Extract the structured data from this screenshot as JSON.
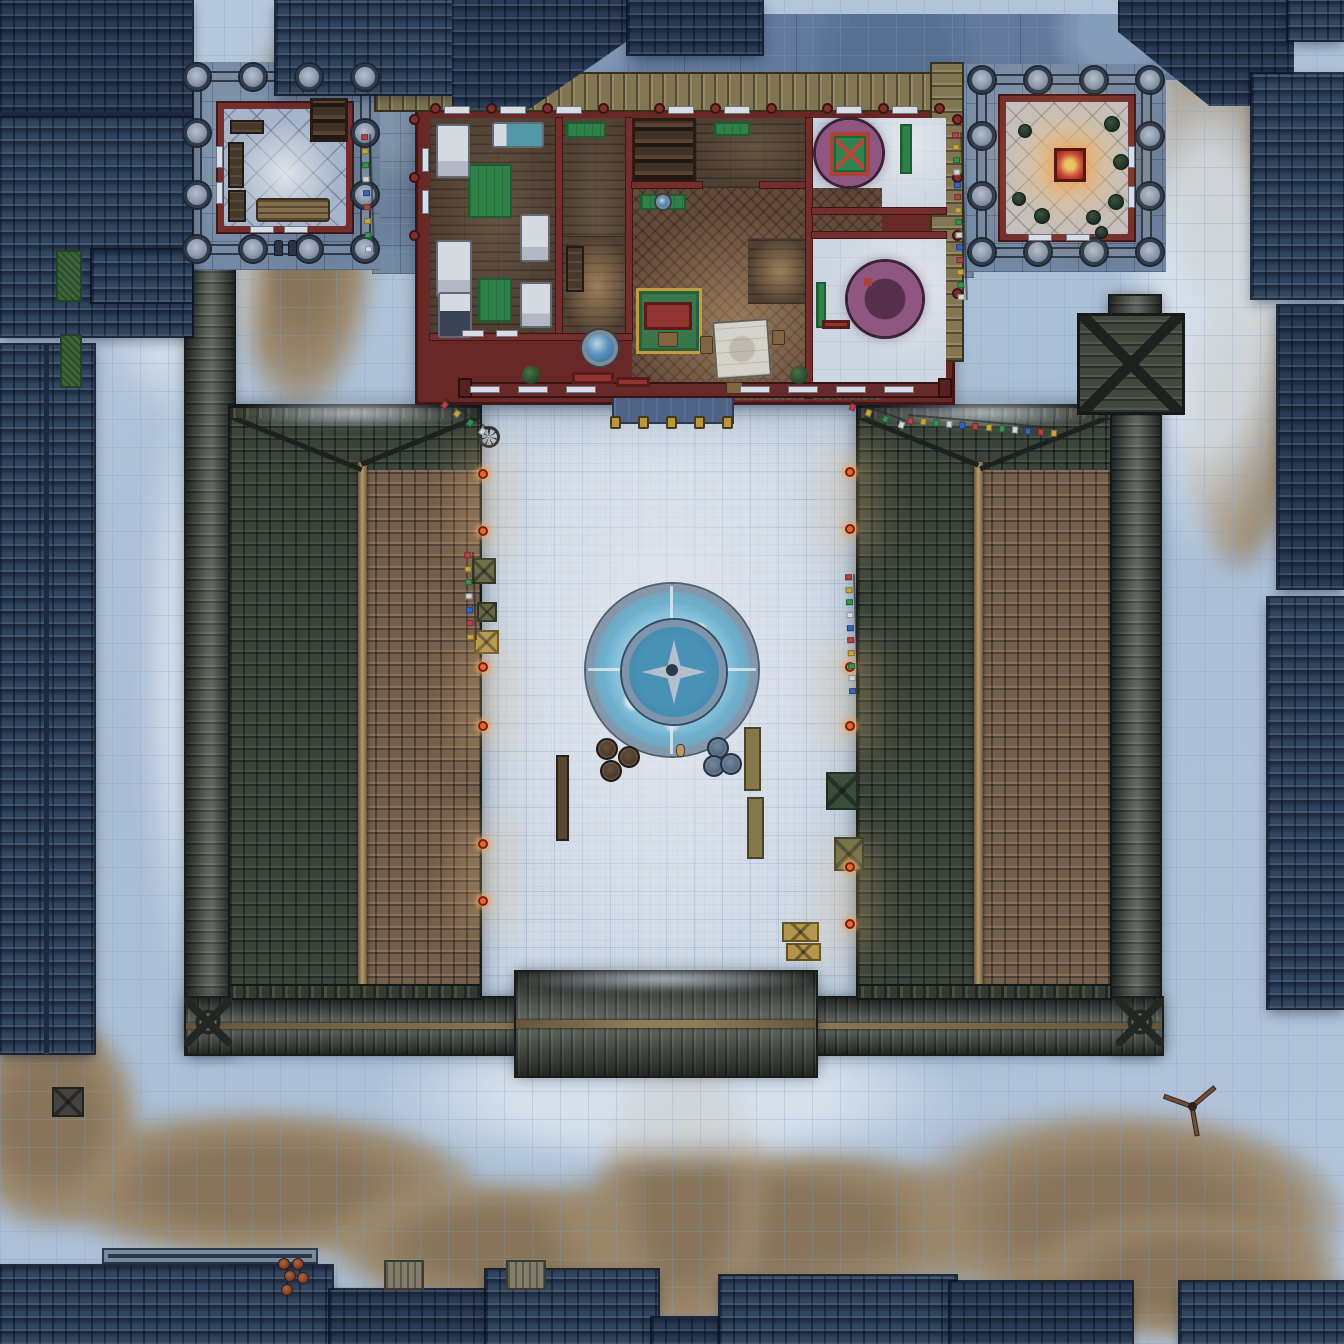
{
  "map": {
    "kind": "top-down fantasy battle map",
    "scene": "snow-covered walled temple compound at night with central frozen fountain courtyard, flanking tiled-roof wings, a northern living-quarters building with two corner towers, a southern gate, and surrounding city rooftops",
    "grid": {
      "columns": 48,
      "rows": 48,
      "cell_px": 28,
      "line_color": "rgba(140,170,205,0.28)"
    },
    "palette": {
      "snow": "#c3d5e7",
      "snow_bright": "#e9f2f9",
      "dirt": "#a8906a",
      "stone_path": "#7d92aa",
      "city_roof": "#33475e",
      "city_roof_dark": "#2a3c52",
      "compound_wall": "#454a37",
      "wing_roof_dark": "#3e4634",
      "wing_roof_lit": "#7d6349",
      "ridge_beam": "#a58a5c",
      "building_red": "#7c2d26",
      "wood_floor": "#55412d",
      "hall_floor": "#6b4c34",
      "tatami_green": "#2f8a43",
      "bath_purple": "#8f4f79",
      "marble_floor": "#dfe7ee",
      "courtyard_ice": "#e3ecf4",
      "fountain_water": "#a9dcee",
      "lamp_orange": "#ff6a2a",
      "lamp_glow": "rgba(255,205,125,0.30)",
      "gold": "#c9a23e",
      "shrine_glow": "#ffd166",
      "flag_colors": [
        "#c44444",
        "#d9b33a",
        "#3a9a4e",
        "#e8e8e8",
        "#3a6ac4"
      ]
    },
    "features": [
      "frozen-fountain",
      "courtyard",
      "left-wing-roof",
      "right-wing-roof",
      "north-building",
      "left-tower",
      "right-tower",
      "glowing-shrine",
      "south-gate",
      "east-gatehouse",
      "prayer-flags",
      "city-rooftops"
    ]
  },
  "objects": {
    "tower_pillars": [
      {
        "x": 184,
        "y": 64
      },
      {
        "x": 240,
        "y": 64
      },
      {
        "x": 296,
        "y": 64
      },
      {
        "x": 352,
        "y": 64
      },
      {
        "x": 184,
        "y": 120
      },
      {
        "x": 352,
        "y": 120
      },
      {
        "x": 184,
        "y": 182
      },
      {
        "x": 352,
        "y": 182
      },
      {
        "x": 184,
        "y": 236
      },
      {
        "x": 240,
        "y": 236
      },
      {
        "x": 296,
        "y": 236
      },
      {
        "x": 352,
        "y": 236
      },
      {
        "x": 969,
        "y": 67
      },
      {
        "x": 1025,
        "y": 67
      },
      {
        "x": 1081,
        "y": 67
      },
      {
        "x": 1137,
        "y": 67
      },
      {
        "x": 969,
        "y": 123
      },
      {
        "x": 1137,
        "y": 123
      },
      {
        "x": 969,
        "y": 183
      },
      {
        "x": 1137,
        "y": 183
      },
      {
        "x": 969,
        "y": 239
      },
      {
        "x": 1025,
        "y": 239
      },
      {
        "x": 1081,
        "y": 239
      },
      {
        "x": 1137,
        "y": 239
      }
    ],
    "lamps": [
      {
        "x": 478,
        "y": 469
      },
      {
        "x": 478,
        "y": 526
      },
      {
        "x": 478,
        "y": 662
      },
      {
        "x": 478,
        "y": 721
      },
      {
        "x": 478,
        "y": 839
      },
      {
        "x": 478,
        "y": 896
      },
      {
        "x": 845,
        "y": 467
      },
      {
        "x": 845,
        "y": 524
      },
      {
        "x": 845,
        "y": 662
      },
      {
        "x": 845,
        "y": 721
      },
      {
        "x": 845,
        "y": 862
      },
      {
        "x": 845,
        "y": 919
      }
    ],
    "gold_posts": [
      {
        "x": 610,
        "y": 416
      },
      {
        "x": 638,
        "y": 416
      },
      {
        "x": 666,
        "y": 416
      },
      {
        "x": 694,
        "y": 416
      },
      {
        "x": 722,
        "y": 416
      }
    ],
    "wall_caps": [
      {
        "x": 430,
        "y": 103
      },
      {
        "x": 486,
        "y": 103
      },
      {
        "x": 542,
        "y": 103
      },
      {
        "x": 598,
        "y": 103
      },
      {
        "x": 654,
        "y": 103
      },
      {
        "x": 710,
        "y": 103
      },
      {
        "x": 766,
        "y": 103
      },
      {
        "x": 822,
        "y": 103
      },
      {
        "x": 878,
        "y": 103
      },
      {
        "x": 934,
        "y": 103
      },
      {
        "x": 409,
        "y": 114
      },
      {
        "x": 409,
        "y": 172
      },
      {
        "x": 409,
        "y": 230
      },
      {
        "x": 952,
        "y": 114
      },
      {
        "x": 952,
        "y": 172
      },
      {
        "x": 952,
        "y": 230
      },
      {
        "x": 952,
        "y": 288
      }
    ],
    "south_posts": [
      {
        "x": 458,
        "y": 378
      },
      {
        "x": 938,
        "y": 378
      }
    ],
    "windows": [
      {
        "x": 444,
        "y": 106,
        "w": 26,
        "h": 8
      },
      {
        "x": 500,
        "y": 106,
        "w": 26,
        "h": 8
      },
      {
        "x": 556,
        "y": 106,
        "w": 26,
        "h": 8
      },
      {
        "x": 668,
        "y": 106,
        "w": 26,
        "h": 8
      },
      {
        "x": 724,
        "y": 106,
        "w": 26,
        "h": 8
      },
      {
        "x": 836,
        "y": 106,
        "w": 26,
        "h": 8
      },
      {
        "x": 892,
        "y": 106,
        "w": 26,
        "h": 8
      },
      {
        "x": 422,
        "y": 148,
        "w": 7,
        "h": 24
      },
      {
        "x": 422,
        "y": 190,
        "w": 7,
        "h": 24
      },
      {
        "x": 462,
        "y": 330,
        "w": 22,
        "h": 7
      },
      {
        "x": 496,
        "y": 330,
        "w": 22,
        "h": 7
      },
      {
        "x": 216,
        "y": 146,
        "w": 7,
        "h": 22
      },
      {
        "x": 216,
        "y": 182,
        "w": 7,
        "h": 22
      },
      {
        "x": 250,
        "y": 226,
        "w": 24,
        "h": 7
      },
      {
        "x": 284,
        "y": 226,
        "w": 24,
        "h": 7
      },
      {
        "x": 1128,
        "y": 146,
        "w": 7,
        "h": 22
      },
      {
        "x": 1128,
        "y": 186,
        "w": 7,
        "h": 22
      },
      {
        "x": 1028,
        "y": 234,
        "w": 24,
        "h": 7
      },
      {
        "x": 1066,
        "y": 234,
        "w": 24,
        "h": 7
      },
      {
        "x": 470,
        "y": 386,
        "w": 30,
        "h": 7
      },
      {
        "x": 518,
        "y": 386,
        "w": 30,
        "h": 7
      },
      {
        "x": 566,
        "y": 386,
        "w": 30,
        "h": 7
      },
      {
        "x": 740,
        "y": 386,
        "w": 30,
        "h": 7
      },
      {
        "x": 788,
        "y": 386,
        "w": 30,
        "h": 7
      },
      {
        "x": 836,
        "y": 386,
        "w": 30,
        "h": 7
      },
      {
        "x": 884,
        "y": 386,
        "w": 30,
        "h": 7
      }
    ],
    "flag_strings": [
      {
        "x": 446,
        "y": 398,
        "len": 52,
        "ang": 35
      },
      {
        "x": 852,
        "y": 400,
        "len": 58,
        "ang": 20
      },
      {
        "x": 908,
        "y": 414,
        "len": 150,
        "ang": 5
      },
      {
        "x": 371,
        "y": 134,
        "len": 118,
        "ang": 88
      },
      {
        "x": 962,
        "y": 132,
        "len": 168,
        "ang": 88
      },
      {
        "x": 474,
        "y": 552,
        "len": 88,
        "ang": 88
      },
      {
        "x": 855,
        "y": 574,
        "len": 120,
        "ang": 88
      }
    ],
    "plants": [
      {
        "x": 1104,
        "y": 116,
        "w": 16,
        "h": 16
      },
      {
        "x": 1113,
        "y": 154,
        "w": 16,
        "h": 16
      },
      {
        "x": 1108,
        "y": 194,
        "w": 16,
        "h": 16
      },
      {
        "x": 1086,
        "y": 210,
        "w": 15,
        "h": 15
      },
      {
        "x": 1034,
        "y": 208,
        "w": 16,
        "h": 16
      },
      {
        "x": 1012,
        "y": 192,
        "w": 14,
        "h": 14
      },
      {
        "x": 1018,
        "y": 124,
        "w": 14,
        "h": 14
      },
      {
        "x": 1095,
        "y": 226,
        "w": 13,
        "h": 13
      }
    ],
    "barrels": [
      {
        "x": 596,
        "y": 738
      },
      {
        "x": 618,
        "y": 746
      },
      {
        "x": 600,
        "y": 760
      },
      {
        "x": 707,
        "y": 737,
        "variant": "teal"
      },
      {
        "x": 703,
        "y": 755,
        "variant": "teal"
      },
      {
        "x": 720,
        "y": 753,
        "variant": "teal"
      }
    ],
    "benches": [
      {
        "x": 556,
        "y": 755,
        "w": 13,
        "h": 86,
        "variant": "woodb"
      },
      {
        "x": 744,
        "y": 727,
        "w": 17,
        "h": 64
      },
      {
        "x": 747,
        "y": 797,
        "w": 17,
        "h": 62
      }
    ],
    "crates": [
      {
        "x": 472,
        "y": 558,
        "w": 24,
        "h": 26,
        "variant": "olive"
      },
      {
        "x": 477,
        "y": 602,
        "w": 20,
        "h": 20,
        "variant": "olive"
      },
      {
        "x": 474,
        "y": 630,
        "w": 25,
        "h": 24,
        "variant": "gold"
      },
      {
        "x": 826,
        "y": 772,
        "w": 32,
        "h": 38,
        "variant": "darkgreen"
      },
      {
        "x": 834,
        "y": 837,
        "w": 30,
        "h": 34,
        "variant": "olive"
      },
      {
        "x": 782,
        "y": 922,
        "w": 37,
        "h": 20,
        "variant": "gold"
      },
      {
        "x": 786,
        "y": 943,
        "w": 35,
        "h": 18,
        "variant": "gold"
      },
      {
        "x": 52,
        "y": 1087,
        "w": 32,
        "h": 30,
        "variant": "darkX"
      }
    ],
    "chimneys": [
      {
        "x": 384,
        "y": 1260,
        "w": 40,
        "h": 30
      },
      {
        "x": 506,
        "y": 1260,
        "w": 40,
        "h": 30
      }
    ],
    "pots": [
      {
        "x": 278,
        "y": 1258
      },
      {
        "x": 292,
        "y": 1258
      },
      {
        "x": 284,
        "y": 1270
      },
      {
        "x": 297,
        "y": 1272
      },
      {
        "x": 281,
        "y": 1284
      }
    ],
    "bushes": [
      {
        "x": 522,
        "y": 366,
        "w": 18,
        "h": 18
      },
      {
        "x": 790,
        "y": 366,
        "w": 18,
        "h": 18
      }
    ],
    "hedges": [
      {
        "x": 56,
        "y": 250,
        "w": 26,
        "h": 52
      },
      {
        "x": 60,
        "y": 334,
        "w": 22,
        "h": 54
      }
    ],
    "statues": [
      {
        "x": 274,
        "y": 240,
        "w": 9,
        "h": 16
      },
      {
        "x": 288,
        "y": 240,
        "w": 9,
        "h": 16
      }
    ],
    "figures": [
      {
        "x": 676,
        "y": 744,
        "w": 9,
        "h": 13
      }
    ],
    "wheels": [
      {
        "x": 478,
        "y": 426,
        "w": 22,
        "h": 22
      }
    ],
    "windmills": [
      {
        "x": 1162,
        "y": 1076,
        "w": 60,
        "h": 60
      }
    ]
  }
}
